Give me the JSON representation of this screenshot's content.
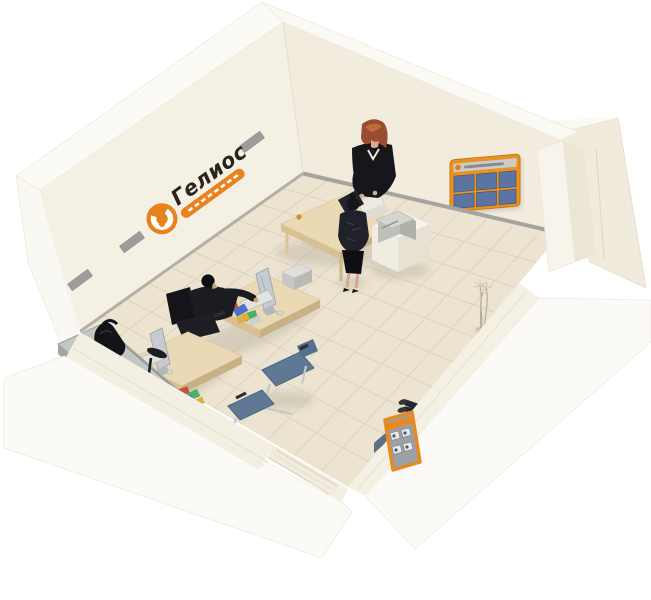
{
  "image": {
    "kind": "3D cutaway isometric render",
    "subject": "Small office / insurance branch interior with staff and visitors",
    "background_color": "#ffffff"
  },
  "branding": {
    "logo_text": "Гелиос",
    "logo_style": "black italic lettering with orange circular emblem and orange ribbon beneath",
    "logo_emblem_color": "#e8821e",
    "wall_stripe_color": "#9c9c98"
  },
  "room": {
    "wall_color": "#f3eee2",
    "wall_top_color": "#fbf9f3",
    "floor_color": "#ece4d1",
    "floor_tile_line_color": "#ddd3bd",
    "baseboard_color": "#a6a49e",
    "features": [
      "back-left wall with company logo and grey stripes",
      "back-right wall with orange-framed info board",
      "right wall with pillar and door opening",
      "low cutaway front walls with entrance gap"
    ]
  },
  "furniture": [
    {
      "name": "manager-desk",
      "description": "light wood desk near back corner with white monitor and cup"
    },
    {
      "name": "pedestal-printer",
      "description": "white cabinet with grey printer/copier beside manager desk"
    },
    {
      "name": "staff-desk-1",
      "description": "light wood workstation with slim monitor, keyboard, mouse, printer and scattered brochures"
    },
    {
      "name": "staff-desk-2",
      "description": "second workstation with slim monitor and keyboard"
    },
    {
      "name": "visitor-chair-1",
      "color": "#5f7894"
    },
    {
      "name": "visitor-chair-2",
      "color": "#5f7894"
    },
    {
      "name": "task-chair",
      "color": "#1f1f24"
    },
    {
      "name": "reception-counter",
      "description": "grey-topped counter with black bag and desk lamp"
    },
    {
      "name": "waiting-sofa",
      "description": "slate-blue modular high-back sofa along front-right wall",
      "color": "#7e90a3"
    },
    {
      "name": "brochure-stand",
      "description": "orange floor display stand with leaflet pockets",
      "color": "#e8891f"
    },
    {
      "name": "info-board",
      "description": "orange-framed wall board with six blue panels and grey header",
      "frame_color": "#e8931f",
      "panel_color": "#5b74a4"
    },
    {
      "name": "plant",
      "description": "thin decorative plant in right corner"
    }
  ],
  "people": [
    {
      "name": "manager-standing",
      "description": "red-haired woman in black suit standing behind the manager desk"
    },
    {
      "name": "client-standing",
      "description": "woman in black dress standing in front of the manager desk"
    },
    {
      "name": "employee-seated",
      "description": "man in dark suit working at staff desk 1"
    },
    {
      "name": "visitor-seated",
      "description": "person in light top seated on the sofa with legs crossed"
    }
  ],
  "palette": {
    "accent_orange": "#e8821e",
    "wood": "#ead9b4",
    "sofa_blue": "#7e90a3",
    "chair_blue": "#5f7894",
    "suit_black": "#17161b",
    "floor_cream": "#ece4d1",
    "wall_cream": "#f3eee2"
  }
}
